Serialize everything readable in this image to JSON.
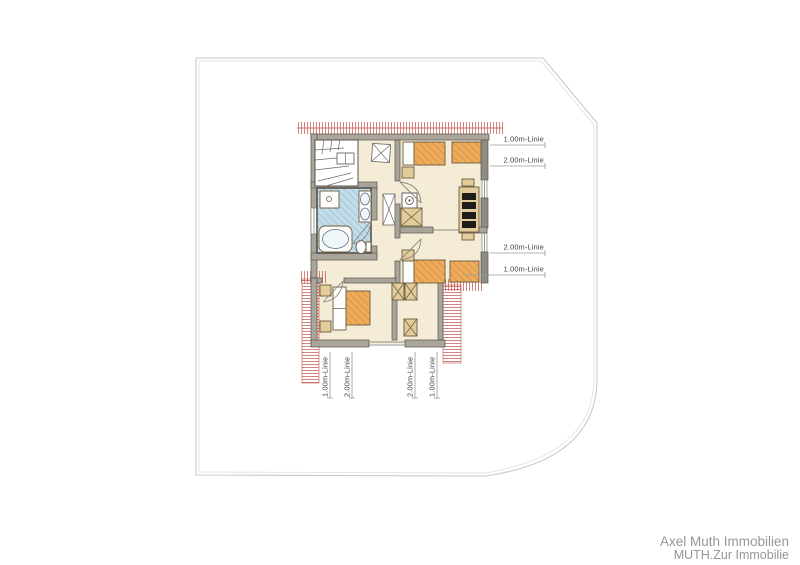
{
  "drawing": {
    "type": "floor-plan",
    "floor": "upper-attic-level"
  },
  "dimensions": {
    "right": [
      "1.00m-Linie",
      "2.00m-Linie",
      "2.00m-Linie",
      "1.00m-Linie"
    ],
    "bottom": [
      "1.00m-Linie",
      "2.00m-Linie",
      "2.00m-Linie",
      "1.00m-Linie"
    ]
  },
  "footer": {
    "line1": "Axel Muth Immobilien",
    "line2": "MUTH.Zur Immobilie"
  },
  "colors": {
    "floor": "#f4ecd7",
    "wall": "#a9a59b",
    "wall_outline": "#57544d",
    "bathroom": "#c3dcea",
    "bed": "#edab5c",
    "roof_hatch_red": "#c05047",
    "site_outline": "#cccccc",
    "footer_text": "#96969a"
  },
  "icons": {
    "staircase": "winder-stairs",
    "bathtub": "bathtub",
    "shower": "shower",
    "sinks": "double-washbasin",
    "toilet": "wc",
    "skylight": "x-marked-skylight",
    "shaft": "x-marked-shaft",
    "beds": "hatched-bed",
    "desk": "dresser-with-chairs"
  }
}
